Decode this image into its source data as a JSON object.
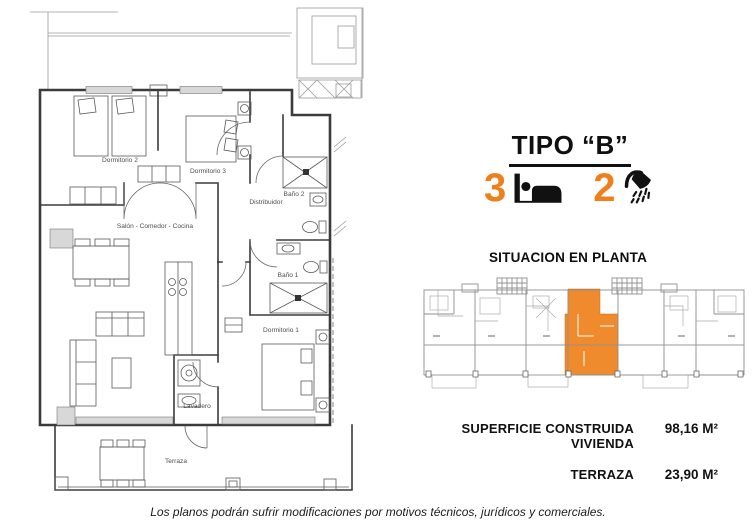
{
  "title": {
    "text": "TIPO “B”"
  },
  "features": {
    "bedrooms_count": "3",
    "bathrooms_count": "2",
    "bed_icon": "bed-icon",
    "shower_icon": "shower-icon"
  },
  "situation": {
    "heading": "SITUACION EN PLANTA"
  },
  "areas": {
    "rows": [
      {
        "label": "SUPERFICIE CONSTRUIDA VIVIENDA",
        "value": "98,16 M²"
      },
      {
        "label": "TERRAZA",
        "value": "23,90 M²"
      }
    ]
  },
  "floorplan": {
    "labels": {
      "dormitorio2": "Dormitorio 2",
      "dormitorio3": "Dormitorio 3",
      "bano2": "Baño 2",
      "distribuidor": "Distribuidor",
      "bano1": "Baño 1",
      "salon": "Salón - Comedor - Cocina",
      "dormitorio1": "Dormitorio 1",
      "lavadero": "Lavadero",
      "terraza": "Terraza"
    }
  },
  "disclaimer": "Los planos podrán sufrir modificaciones por motivos técnicos, jurídicos y comerciales.",
  "colors": {
    "accent_orange": "#EF7F1B",
    "plan_highlight": "#F08B2D",
    "plan_line": "#3b3b3b",
    "situation_line": "#8f8f8f"
  }
}
